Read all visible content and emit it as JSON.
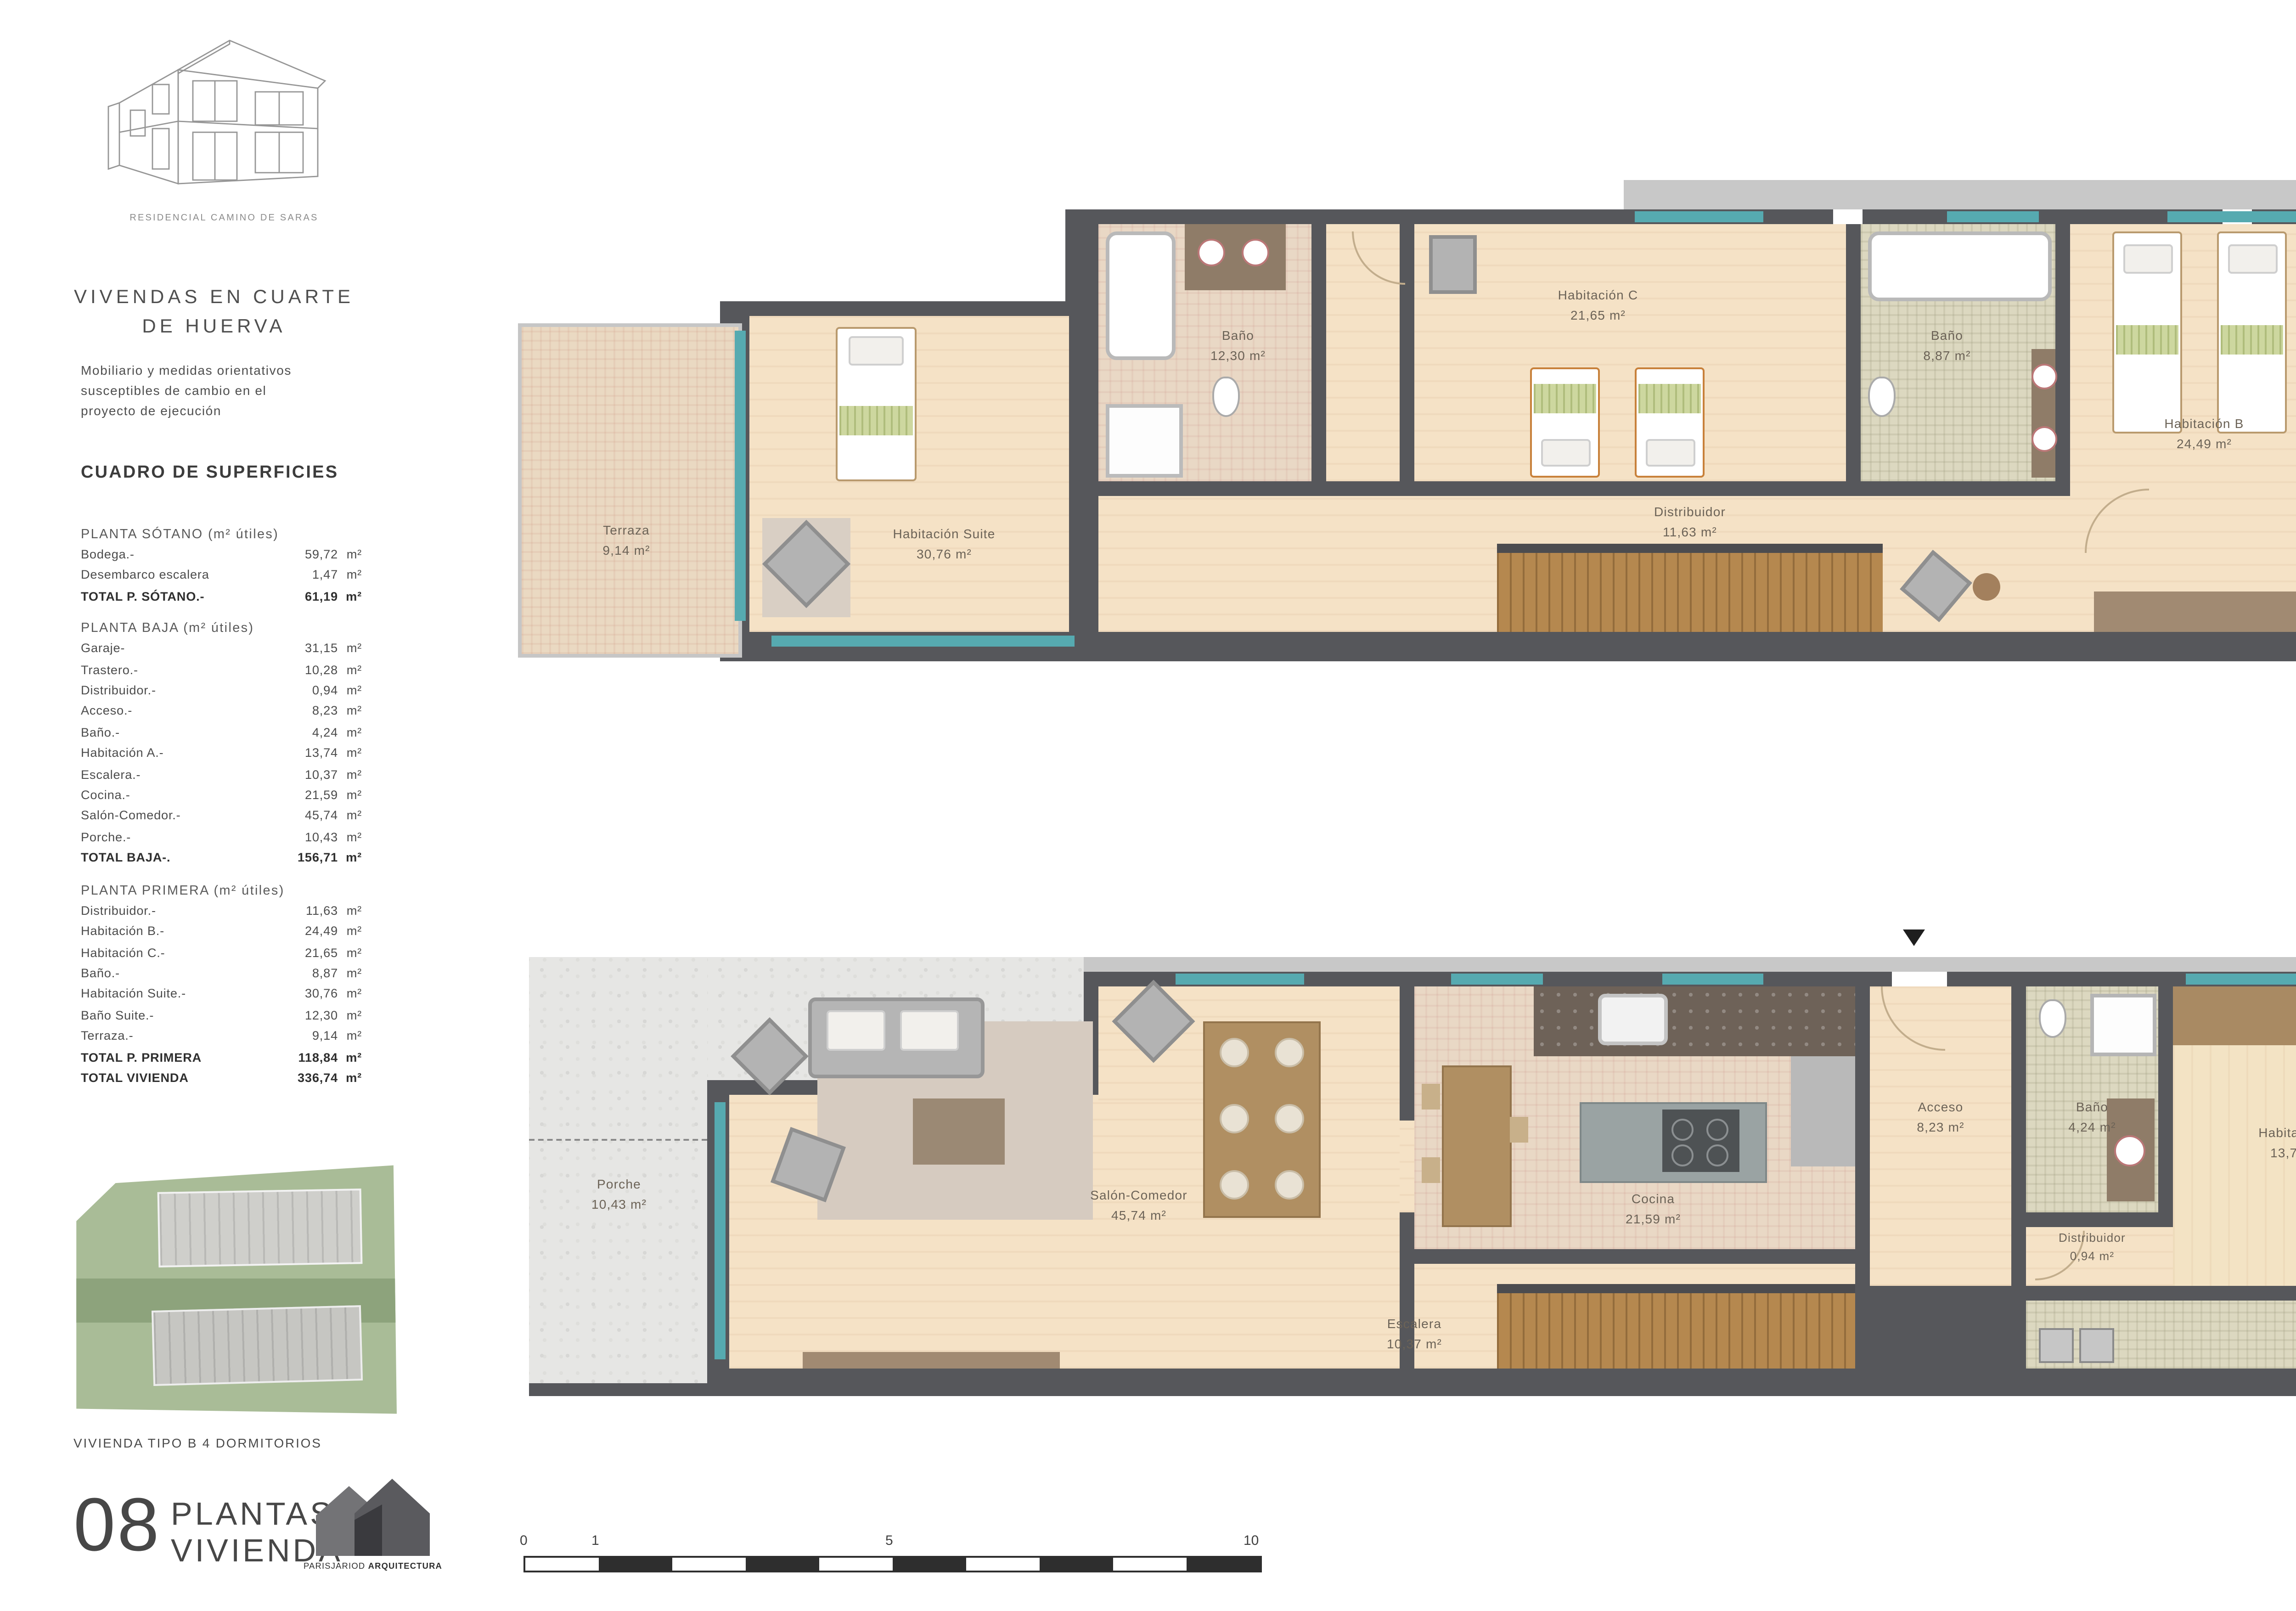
{
  "sidebar": {
    "logo_caption": "RESIDENCIAL CAMINO DE SARAS",
    "title_line1": "VIVENDAS EN CUARTE",
    "title_line2": "DE HUERVA",
    "disclaimer_line1": "Mobiliario y medidas orientativos",
    "disclaimer_line2": "susceptibles de cambio en el",
    "disclaimer_line3": "proyecto de ejecución",
    "table_title": "CUADRO DE SUPERFICIES",
    "sections": [
      {
        "heading": "PLANTA SÓTANO (m² útiles)",
        "rows": [
          {
            "label": "Bodega.-",
            "value": "59,72",
            "unit": "m²"
          },
          {
            "label": "Desembarco escalera",
            "value": "1,47",
            "unit": "m²"
          },
          {
            "label": "TOTAL P. SÓTANO.-",
            "value": "61,19",
            "unit": "m²"
          }
        ]
      },
      {
        "heading": "PLANTA BAJA (m² útiles)",
        "rows": [
          {
            "label": "Garaje-",
            "value": "31,15",
            "unit": "m²"
          },
          {
            "label": "Trastero.-",
            "value": "10,28",
            "unit": "m²"
          },
          {
            "label": "Distribuidor.-",
            "value": "0,94",
            "unit": "m²"
          },
          {
            "label": "Acceso.-",
            "value": "8,23",
            "unit": "m²"
          },
          {
            "label": "Baño.-",
            "value": "4,24",
            "unit": "m²"
          },
          {
            "label": "Habitación A.-",
            "value": "13,74",
            "unit": "m²"
          },
          {
            "label": "Escalera.-",
            "value": "10,37",
            "unit": "m²"
          },
          {
            "label": "Cocina.-",
            "value": "21,59",
            "unit": "m²"
          },
          {
            "label": "Salón-Comedor.-",
            "value": "45,74",
            "unit": "m²"
          },
          {
            "label": "Porche.-",
            "value": "10,43",
            "unit": "m²"
          },
          {
            "label": "TOTAL BAJA-.",
            "value": "156,71",
            "unit": "m²"
          }
        ]
      },
      {
        "heading": "PLANTA PRIMERA (m² útiles)",
        "rows": [
          {
            "label": "Distribuidor.-",
            "value": "11,63",
            "unit": "m²"
          },
          {
            "label": "Habitación B.-",
            "value": "24,49",
            "unit": "m²"
          },
          {
            "label": "Habitación C.-",
            "value": "21,65",
            "unit": "m²"
          },
          {
            "label": "Baño.-",
            "value": "8,87",
            "unit": "m²"
          },
          {
            "label": "Habitación Suite.-",
            "value": "30,76",
            "unit": "m²"
          },
          {
            "label": "Baño Suite.-",
            "value": "12,30",
            "unit": "m²"
          },
          {
            "label": "Terraza.-",
            "value": "9,14",
            "unit": "m²"
          },
          {
            "label": "TOTAL P. PRIMERA",
            "value": "118,84",
            "unit": "m²"
          },
          {
            "label": "TOTAL VIVIENDA",
            "value": "336,74",
            "unit": "m²"
          }
        ]
      }
    ],
    "type_caption": "VIVIENDA TIPO B 4 DORMITORIOS",
    "sheet_number": "08",
    "sheet_label_line1": "PLANTAS",
    "sheet_label_line2": "VIVIENDA",
    "studio_name_regular": "PARISJARIOD",
    "studio_name_bold": "ARQUITECTURA"
  },
  "plans": {
    "first_floor": {
      "rooms": {
        "terraza": {
          "name": "Terraza",
          "area": "9,14 m²"
        },
        "suite": {
          "name": "Habitación Suite",
          "area": "30,76 m²"
        },
        "bano_suite": {
          "name": "Baño",
          "area": "12,30 m²"
        },
        "hab_c": {
          "name": "Habitación C",
          "area": "21,65 m²"
        },
        "distribuidor": {
          "name": "Distribuidor",
          "area": "11,63 m²"
        },
        "bano": {
          "name": "Baño",
          "area": "8,87 m²"
        },
        "hab_b": {
          "name": "Habitación B",
          "area": "24,49 m²"
        }
      }
    },
    "ground_floor": {
      "rooms": {
        "porche": {
          "name": "Porche",
          "area": "10,43 m²"
        },
        "salon": {
          "name": "Salón-Comedor",
          "area": "45,74 m²"
        },
        "cocina": {
          "name": "Cocina",
          "area": "21,59 m²"
        },
        "escalera": {
          "name": "Escalera",
          "area": "10,37 m²"
        },
        "acceso": {
          "name": "Acceso",
          "area": "8,23 m²"
        },
        "bano": {
          "name": "Baño",
          "area": "4,24 m²"
        },
        "distribuidor": {
          "name": "Distribuidor",
          "area": "0,94 m²"
        },
        "hab_a": {
          "name": "Habitación A",
          "area": "13,74 m²"
        },
        "trastero": {
          "name": "Trastero",
          "area": "10,28 m²"
        },
        "garaje": {
          "name": "Garaje",
          "area": "31,15 m²"
        }
      }
    }
  },
  "scale_bar": {
    "labels": [
      "0",
      "1",
      "5",
      "10"
    ]
  }
}
